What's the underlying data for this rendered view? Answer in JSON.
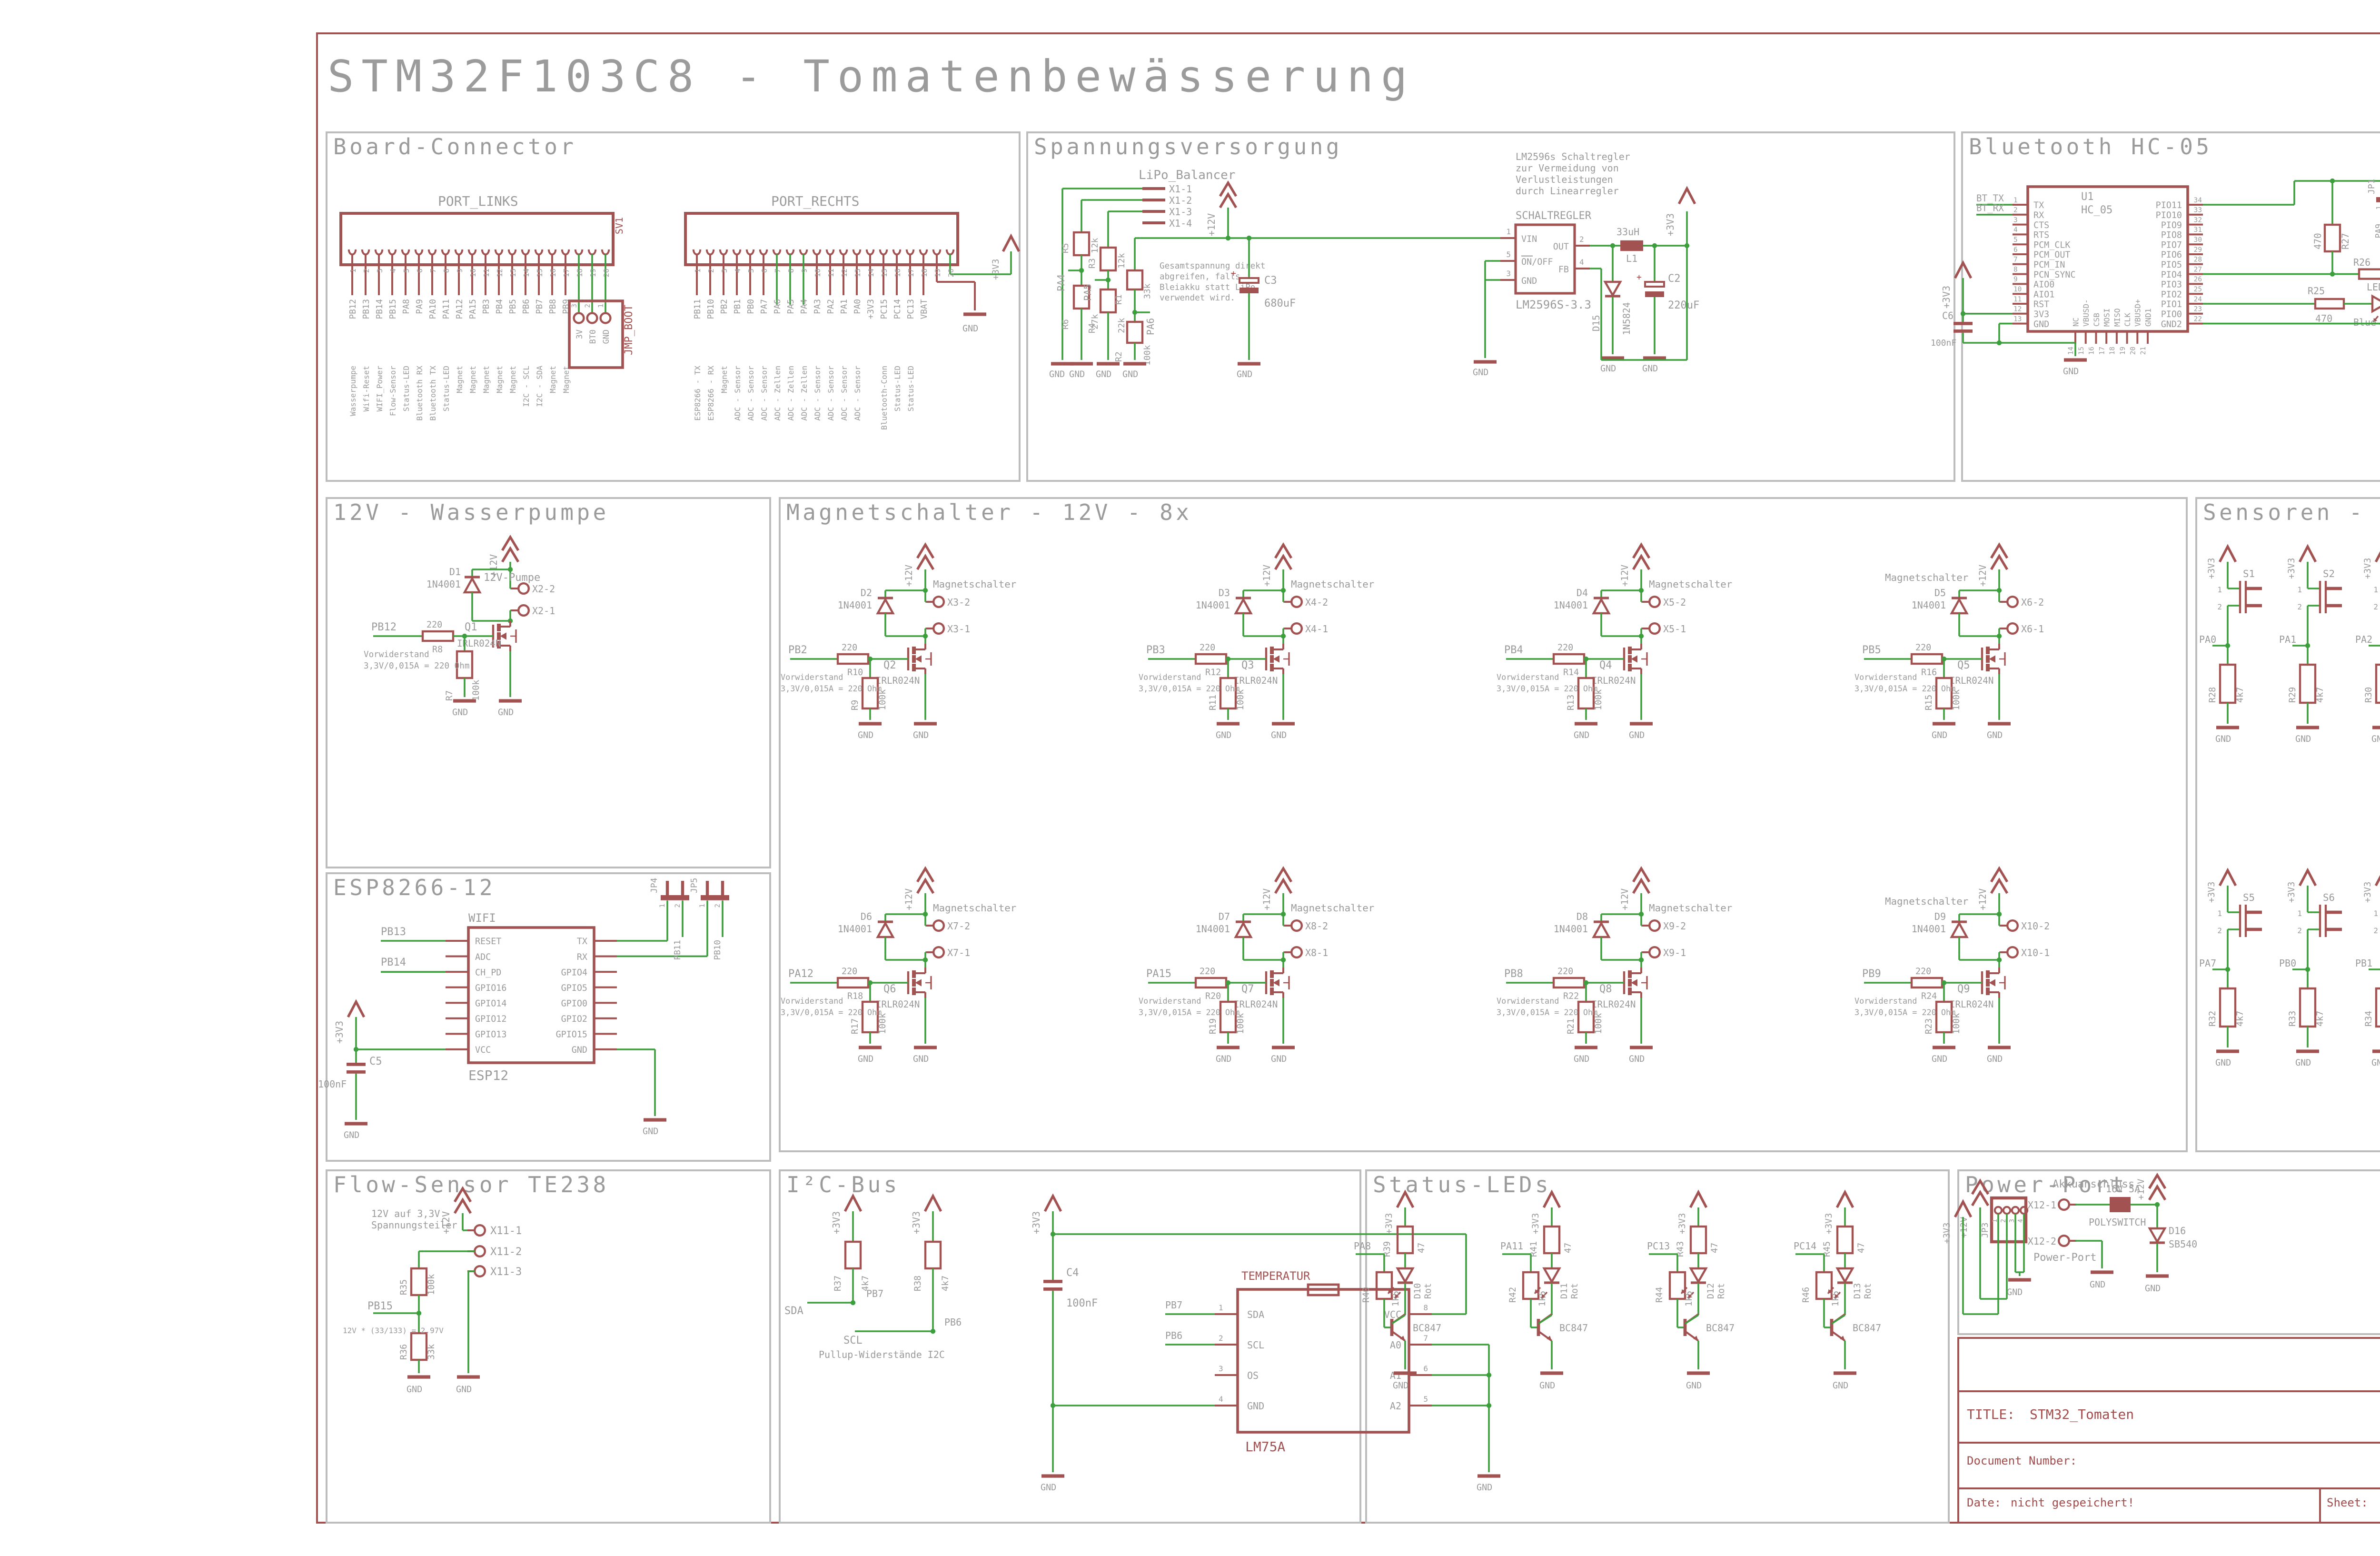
{
  "page": {
    "title": "STM32F103C8 - Tomatenbewässerung"
  },
  "labels": {
    "gnd": "GND",
    "p3v3": "+3V3",
    "p12v": "+12V",
    "plus": "+",
    "vor1": "Vorwiderstand",
    "vor2": "3,3V/0,015A = 220 Ohm",
    "ms": "Magnetschalter"
  },
  "title_block": {
    "title_label": "TITLE:",
    "title": "STM32_Tomaten",
    "doc": "Document Number:",
    "rev": "REV:",
    "date_label": "Date:",
    "date": "nicht gespeichert!",
    "sheet_label": "Sheet:",
    "sheet": "1/1"
  },
  "sections": {
    "board": {
      "title": "Board-Connector",
      "left_header": "PORT_LINKS",
      "right_header": "PORT_RECHTS",
      "ref": "SV1",
      "jmp": {
        "ref": "JMP_BOOT",
        "pins": [
          "3",
          "2",
          "1"
        ],
        "nets": [
          "3V",
          "BT0",
          "GND"
        ]
      },
      "left_pins": [
        {
          "pin": "1",
          "net": "PB12",
          "fn": "Wasserpumpe"
        },
        {
          "pin": "2",
          "net": "PB13",
          "fn": "Wifi-Reset"
        },
        {
          "pin": "3",
          "net": "PB14",
          "fn": "WIFI_Power"
        },
        {
          "pin": "4",
          "net": "PB15",
          "fn": "Flow-Sensor"
        },
        {
          "pin": "5",
          "net": "PA8",
          "fn": "Status-LED"
        },
        {
          "pin": "6",
          "net": "PA9",
          "fn": "Bluetooth RX"
        },
        {
          "pin": "7",
          "net": "PA10",
          "fn": "Bluetooth TX"
        },
        {
          "pin": "8",
          "net": "PA11",
          "fn": "Status-LED"
        },
        {
          "pin": "9",
          "net": "PA12",
          "fn": "Magnet"
        },
        {
          "pin": "10",
          "net": "PA15",
          "fn": "Magnet"
        },
        {
          "pin": "11",
          "net": "PB3",
          "fn": "Magnet"
        },
        {
          "pin": "12",
          "net": "PB4",
          "fn": "Magnet"
        },
        {
          "pin": "13",
          "net": "PB5",
          "fn": "Magnet"
        },
        {
          "pin": "14",
          "net": "PB6",
          "fn": "I2C - SCL"
        },
        {
          "pin": "15",
          "net": "PB7",
          "fn": "I2C - SDA"
        },
        {
          "pin": "16",
          "net": "PB8",
          "fn": "Magnet"
        },
        {
          "pin": "17",
          "net": "PB9",
          "fn": "Magnet"
        },
        {
          "pin": "18",
          "net": "",
          "fn": ""
        },
        {
          "pin": "19",
          "net": "",
          "fn": ""
        },
        {
          "pin": "20",
          "net": "",
          "fn": ""
        }
      ],
      "right_pins": [
        {
          "pin": "1",
          "net": "PB11",
          "fn": "ESP8266 - TX"
        },
        {
          "pin": "2",
          "net": "PB10",
          "fn": "ESP8266 - RX"
        },
        {
          "pin": "3",
          "net": "PB2",
          "fn": "Magnet"
        },
        {
          "pin": "4",
          "net": "PB1",
          "fn": "ADC - Sensor"
        },
        {
          "pin": "5",
          "net": "PB0",
          "fn": "ADC - Sensor"
        },
        {
          "pin": "6",
          "net": "PA7",
          "fn": "ADC - Sensor"
        },
        {
          "pin": "7",
          "net": "PA6",
          "fn": "ADC - Zellen"
        },
        {
          "pin": "8",
          "net": "PA5",
          "fn": "ADC - Zellen"
        },
        {
          "pin": "9",
          "net": "PA4",
          "fn": "ADC - Zellen"
        },
        {
          "pin": "10",
          "net": "PA3",
          "fn": "ADC - Sensor"
        },
        {
          "pin": "11",
          "net": "PA2",
          "fn": "ADC - Sensor"
        },
        {
          "pin": "12",
          "net": "PA1",
          "fn": "ADC - Sensor"
        },
        {
          "pin": "13",
          "net": "PA0",
          "fn": "ADC - Sensor"
        },
        {
          "pin": "14",
          "net": "+3V3",
          "fn": ""
        },
        {
          "pin": "15",
          "net": "PC15",
          "fn": "Bluetooth-Conn"
        },
        {
          "pin": "16",
          "net": "PC14",
          "fn": "Status-LED"
        },
        {
          "pin": "17",
          "net": "PC13",
          "fn": "Status-LED"
        },
        {
          "pin": "18",
          "net": "VBAT",
          "fn": ""
        },
        {
          "pin": "19",
          "net": "",
          "fn": ""
        },
        {
          "pin": "20",
          "net": "",
          "fn": ""
        }
      ]
    },
    "spann": {
      "title": "Spannungsversorgung",
      "balancer": "LiPo_Balancer",
      "x1": [
        "X1-1",
        "X1-2",
        "X1-3",
        "X1-4"
      ],
      "r5": {
        "r": "R5",
        "v": "12k"
      },
      "r6": {
        "r": "R6",
        "v": "27k"
      },
      "r3": {
        "r": "R3",
        "v": "12k"
      },
      "r4": {
        "r": "R4",
        "v": "22k"
      },
      "r1": {
        "r": "R1",
        "v": "33k"
      },
      "r2": {
        "r": "R2",
        "v": "100k"
      },
      "pa4": "PA4",
      "pa5": "PA5",
      "pa6": "PA6",
      "note1": [
        "Gesamtspannung direkt",
        "abgreifen, falls",
        "Bleiakku statt LiPo",
        "verwendet wird."
      ],
      "note2": [
        "LM2596s Schaltregler",
        "zur Vermeidung von",
        "Verlustleistungen",
        "durch Linearregler"
      ],
      "reg": {
        "label": "SCHALTREGLER",
        "part": "LM2596S-3.3",
        "vin": "VIN",
        "onoff": "ON/OFF",
        "gnd": "GND",
        "out": "OUT",
        "fb": "FB",
        "n_vin": "1",
        "n_onoff": "5",
        "n_gnd": "3",
        "n_out": "2",
        "n_fb": "4"
      },
      "c3": {
        "r": "C3",
        "v": "680uF"
      },
      "l1": {
        "r": "L1",
        "v": "33uH"
      },
      "d15": {
        "r": "D15",
        "v": "1N5824"
      },
      "c2": {
        "r": "C2",
        "v": "220uF"
      }
    },
    "bt": {
      "title": "Bluetooth HC-05",
      "u1": "U1",
      "part": "HC_05",
      "pc15": "PC15",
      "left": [
        {
          "p": "1",
          "n": "TX",
          "net": "BT_TX"
        },
        {
          "p": "2",
          "n": "RX",
          "net": "BT_RX"
        },
        {
          "p": "3",
          "n": "CTS"
        },
        {
          "p": "4",
          "n": "RTS"
        },
        {
          "p": "5",
          "n": "PCM_CLK"
        },
        {
          "p": "6",
          "n": "PCM_OUT"
        },
        {
          "p": "7",
          "n": "PCM_IN"
        },
        {
          "p": "8",
          "n": "PCN_SYNC"
        },
        {
          "p": "9",
          "n": "AIO0"
        },
        {
          "p": "10",
          "n": "AIO1"
        },
        {
          "p": "11",
          "n": "RST"
        },
        {
          "p": "12",
          "n": "3V3"
        },
        {
          "p": "13",
          "n": "GND"
        }
      ],
      "bottom": [
        {
          "p": "14",
          "n": "NC"
        },
        {
          "p": "15",
          "n": "VBUSD-"
        },
        {
          "p": "16",
          "n": "CSB"
        },
        {
          "p": "17",
          "n": "MOSI"
        },
        {
          "p": "18",
          "n": "MISO"
        },
        {
          "p": "19",
          "n": "CLK"
        },
        {
          "p": "20",
          "n": "VBUSD+"
        },
        {
          "p": "21",
          "n": "GND1"
        }
      ],
      "right": [
        {
          "p": "34",
          "n": "PIO11"
        },
        {
          "p": "33",
          "n": "PIO10"
        },
        {
          "p": "32",
          "n": "PIO9"
        },
        {
          "p": "31",
          "n": "PIO8"
        },
        {
          "p": "30",
          "n": "PIO7"
        },
        {
          "p": "29",
          "n": "PIO6"
        },
        {
          "p": "28",
          "n": "PIO5"
        },
        {
          "p": "27",
          "n": "PIO4"
        },
        {
          "p": "26",
          "n": "PIO3"
        },
        {
          "p": "25",
          "n": "PIO2"
        },
        {
          "p": "24",
          "n": "PIO1"
        },
        {
          "p": "23",
          "n": "PIO0"
        },
        {
          "p": "22",
          "n": "GND2"
        }
      ],
      "r27": {
        "r": "R27",
        "v": "470"
      },
      "r26": {
        "r": "R26",
        "v": "10k"
      },
      "r25": {
        "r": "R25",
        "v": "470"
      },
      "led": {
        "r": "LED1",
        "v": "Blue"
      },
      "c6": {
        "r": "C6",
        "v": "100nF"
      },
      "jp1": {
        "ref": "JP1",
        "p1": "1",
        "p2": "2",
        "n1": "PA9",
        "n2": "BT_RX"
      },
      "jp2": {
        "ref": "JP2",
        "p1": "1",
        "p2": "2",
        "n1": "PA10",
        "n2": "BT_TX"
      }
    },
    "pump": {
      "title": "12V - Wasserpumpe",
      "net": "PB12",
      "label": "12V-Pumpe",
      "x2": "X2-2",
      "x1": "X2-1",
      "r8": {
        "r": "R8",
        "v": "220"
      },
      "r7": {
        "r": "R7",
        "v": "100k"
      },
      "q1": {
        "r": "Q1",
        "v": "IRLR024N"
      },
      "d1": {
        "r": "D1",
        "v": "1N4001"
      }
    },
    "magnet": {
      "title": "Magnetschalter - 12V - 8x",
      "channels": [
        {
          "net": "PB2",
          "rg": "R10",
          "rgv": "220",
          "rp": "R9",
          "rpv": "100k",
          "q": "Q2",
          "qv": "IRLR024N",
          "d": "D2",
          "dv": "1N4001",
          "x2": "X3-2",
          "x1": "X3-1"
        },
        {
          "net": "PB3",
          "rg": "R12",
          "rgv": "220",
          "rp": "R11",
          "rpv": "100k",
          "q": "Q3",
          "qv": "IRLR024N",
          "d": "D3",
          "dv": "1N4001",
          "x2": "X4-2",
          "x1": "X4-1"
        },
        {
          "net": "PB4",
          "rg": "R14",
          "rgv": "220",
          "rp": "R13",
          "rpv": "100k",
          "q": "Q4",
          "qv": "IRLR024N",
          "d": "D4",
          "dv": "1N4001",
          "x2": "X5-2",
          "x1": "X5-1"
        },
        {
          "net": "PB5",
          "rg": "R16",
          "rgv": "220",
          "rp": "R15",
          "rpv": "100k",
          "q": "Q5",
          "qv": "IRLR024N",
          "d": "D5",
          "dv": "1N4001",
          "x2": "X6-2",
          "x1": "X6-1"
        },
        {
          "net": "PA12",
          "rg": "R18",
          "rgv": "220",
          "rp": "R17",
          "rpv": "100k",
          "q": "Q6",
          "qv": "IRLR024N",
          "d": "D6",
          "dv": "1N4001",
          "x2": "X7-2",
          "x1": "X7-1"
        },
        {
          "net": "PA15",
          "rg": "R20",
          "rgv": "220",
          "rp": "R19",
          "rpv": "100k",
          "q": "Q7",
          "qv": "IRLR024N",
          "d": "D7",
          "dv": "1N4001",
          "x2": "X8-2",
          "x1": "X8-1"
        },
        {
          "net": "PB8",
          "rg": "R22",
          "rgv": "220",
          "rp": "R21",
          "rpv": "100k",
          "q": "Q8",
          "qv": "IRLR024N",
          "d": "D8",
          "dv": "1N4001",
          "x2": "X9-2",
          "x1": "X9-1"
        },
        {
          "net": "PB9",
          "rg": "R24",
          "rgv": "220",
          "rp": "R23",
          "rpv": "100k",
          "q": "Q9",
          "qv": "IRLR024N",
          "d": "D9",
          "dv": "1N4001",
          "x2": "X10-2",
          "x1": "X10-1"
        }
      ]
    },
    "sens": {
      "title": "Sensoren - 7x",
      "pin1": "1",
      "pin2": "2",
      "channels": [
        {
          "ref": "S1",
          "net": "PA0",
          "r": "R28",
          "v": "4k7"
        },
        {
          "ref": "S2",
          "net": "PA1",
          "r": "R29",
          "v": "4k7"
        },
        {
          "ref": "S3",
          "net": "PA2",
          "r": "R30",
          "v": "4k7"
        },
        {
          "ref": "S4",
          "net": "PA3",
          "r": "R31",
          "v": "4k7"
        },
        {
          "ref": "S5",
          "net": "PA7",
          "r": "R32",
          "v": "4k7"
        },
        {
          "ref": "S6",
          "net": "PB0",
          "r": "R33",
          "v": "4k7"
        },
        {
          "ref": "S7",
          "net": "PB1",
          "r": "R34",
          "v": "4k7"
        }
      ]
    },
    "esp": {
      "title": "ESP8266-12",
      "wifi": "WIFI",
      "part": "ESP12",
      "left": [
        "RESET",
        "ADC",
        "CH_PD",
        "GPIO16",
        "GPIO14",
        "GPIO12",
        "GPIO13",
        "VCC"
      ],
      "right": [
        "TX",
        "RX",
        "GPIO4",
        "GPIO5",
        "GPIO0",
        "GPIO2",
        "GPIO15",
        "GND"
      ],
      "pb13": "PB13",
      "pb14": "PB14",
      "jp4": {
        "ref": "JP4",
        "p1": "1",
        "p2": "2",
        "net": "PB11"
      },
      "jp5": {
        "ref": "JP5",
        "p1": "1",
        "p2": "2",
        "net": "PB10"
      },
      "c5": {
        "r": "C5",
        "v": "100nF"
      }
    },
    "flow": {
      "title": "Flow-Sensor TE238",
      "note": [
        "12V auf 3,3V",
        "Spannungsteiler"
      ],
      "x": [
        "X11-1",
        "X11-2",
        "X11-3"
      ],
      "r35": {
        "r": "R35",
        "v": "100k"
      },
      "r36": {
        "r": "R36",
        "v": "33k"
      },
      "net": "PB15",
      "formula": "12V * (33/133) = 2,97V"
    },
    "i2c": {
      "title": "I²C-Bus",
      "r37": {
        "r": "R37",
        "v": "4k7"
      },
      "r38": {
        "r": "R38",
        "v": "4k7"
      },
      "sda": "SDA",
      "scl": "SCL",
      "pb7": "PB7",
      "pb6": "PB6",
      "note": "Pullup-Widerstände I2C",
      "c4": {
        "r": "C4",
        "v": "100nF"
      },
      "chip": {
        "label": "TEMPERATUR",
        "part": "LM75A",
        "left": [
          {
            "p": "1",
            "n": "SDA",
            "net": "PB7"
          },
          {
            "p": "2",
            "n": "SCL",
            "net": "PB6"
          },
          {
            "p": "3",
            "n": "OS"
          },
          {
            "p": "4",
            "n": "GND"
          }
        ],
        "right": [
          {
            "p": "8",
            "n": "VCC"
          },
          {
            "p": "7",
            "n": "A0"
          },
          {
            "p": "6",
            "n": "A1"
          },
          {
            "p": "5",
            "n": "A2"
          }
        ]
      }
    },
    "leds": {
      "title": "Status-LEDs",
      "channels": [
        {
          "net": "PA8",
          "rc": "R39",
          "rcv": "47",
          "rb": "R40",
          "rbv": "1k5",
          "d": "D10",
          "dv": "Rot",
          "t": "BC847"
        },
        {
          "net": "PA11",
          "rc": "R41",
          "rcv": "47",
          "rb": "R42",
          "rbv": "1k5",
          "d": "D11",
          "dv": "Rot",
          "t": "BC847"
        },
        {
          "net": "PC13",
          "rc": "R43",
          "rcv": "47",
          "rb": "R44",
          "rbv": "1k5",
          "d": "D12",
          "dv": "Rot",
          "t": "BC847"
        },
        {
          "net": "PC14",
          "rc": "R45",
          "rcv": "47",
          "rb": "R46",
          "rbv": "1k5",
          "d": "D13",
          "dv": "Rot",
          "t": "BC847"
        }
      ]
    },
    "pwr": {
      "title": "Power-Port",
      "label": "Power-Port",
      "akku": "Akkuanschluss",
      "jp3": {
        "ref": "JP3",
        "pins": [
          "1",
          "2",
          "3",
          "4"
        ]
      },
      "x1": "X12-1",
      "x2": "X12-2",
      "poly": {
        "label": "POLYSWITCH",
        "rating": "16V 5A"
      },
      "d16": {
        "r": "D16",
        "v": "SB540"
      }
    }
  }
}
